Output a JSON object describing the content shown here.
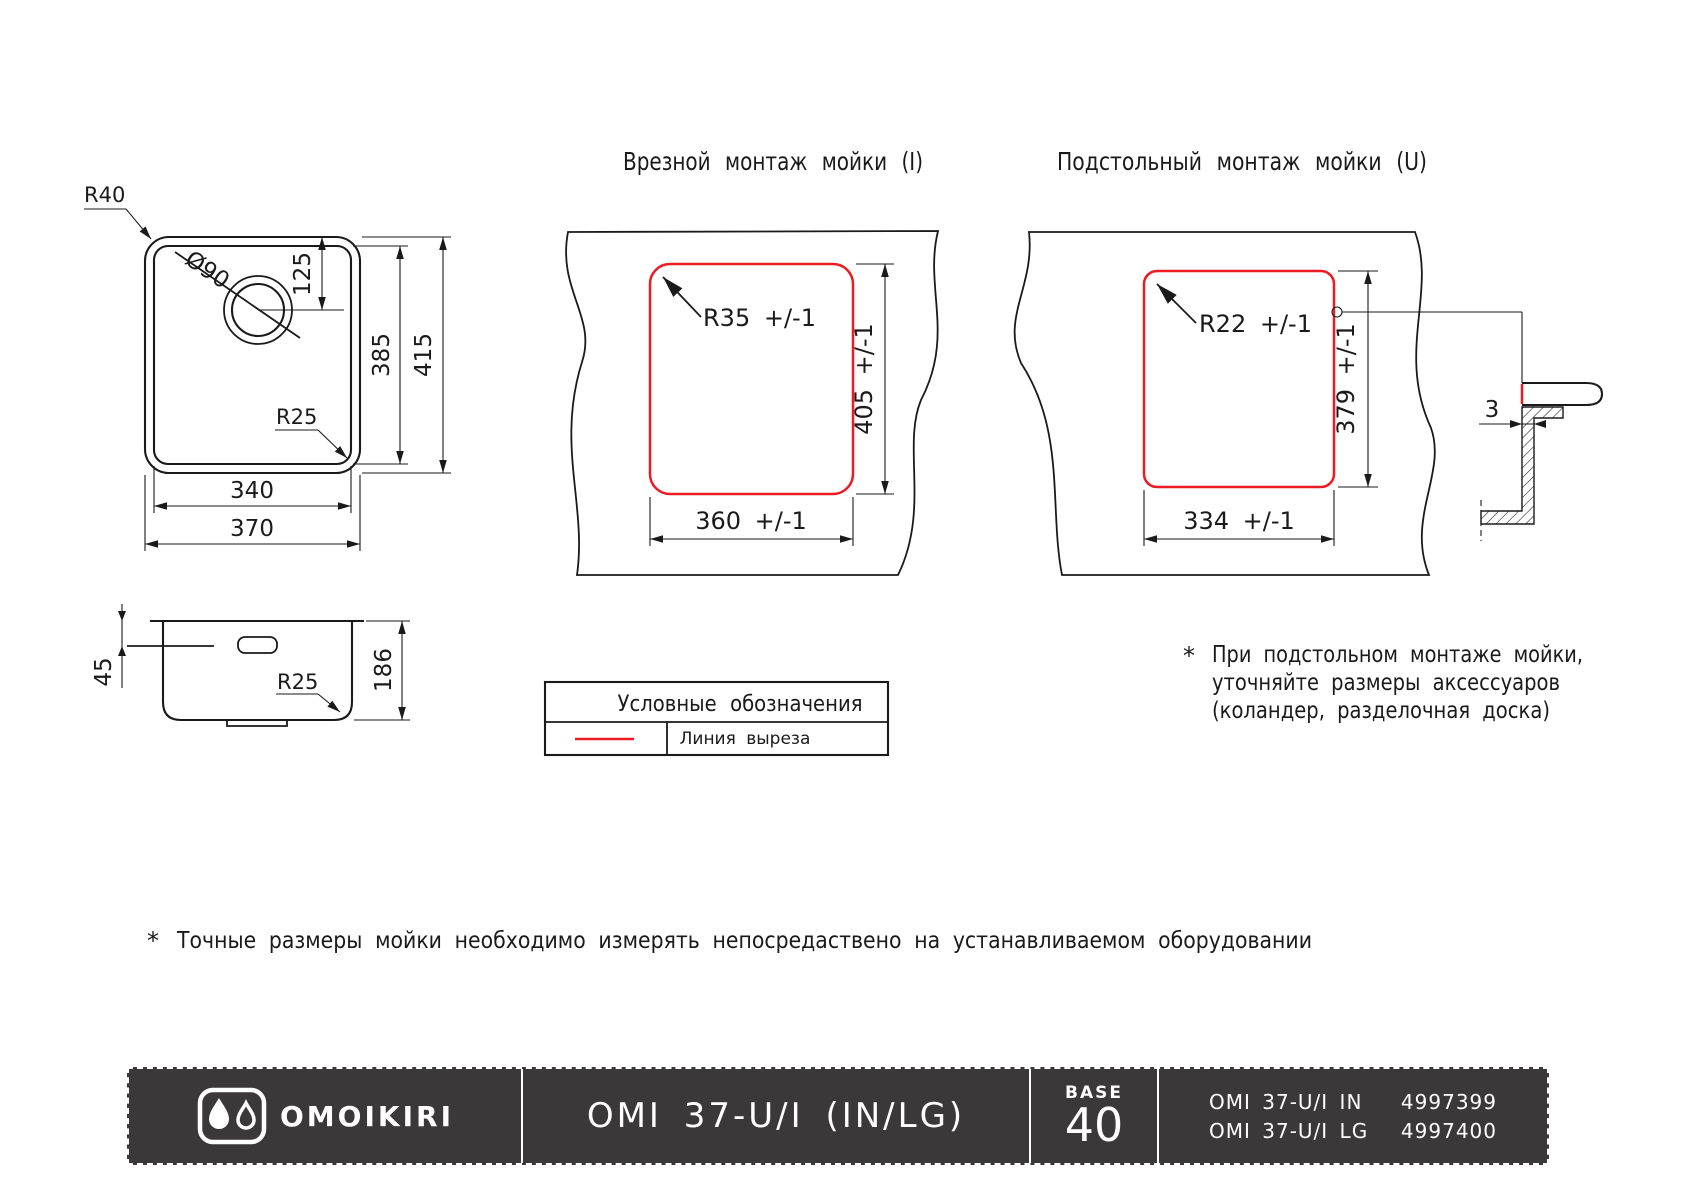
{
  "top_view": {
    "corner_radius": "R40",
    "drain_diameter": "Ø90",
    "drain_offset": "125",
    "inner_height": "385",
    "outer_height": "415",
    "inner_radius": "R25",
    "inner_width": "340",
    "outer_width": "370"
  },
  "side_view": {
    "rim_depth": "45",
    "height": "186",
    "bottom_radius": "R25"
  },
  "inset_mount": {
    "title": "Врезной монтаж мойки (I)",
    "corner_radius": "R35 +/-1",
    "cutout_height": "405 +/-1",
    "cutout_width": "360 +/-1"
  },
  "under_mount": {
    "title": "Подстольный монтаж мойки (U)",
    "corner_radius": "R22 +/-1",
    "cutout_height": "379 +/-1",
    "cutout_width": "334 +/-1",
    "edge_gap": "3"
  },
  "legend": {
    "title": "Условные обозначения",
    "cut_line": "Линия выреза"
  },
  "notes": {
    "under_star": "*",
    "under_line1": "При подстольном монтаже мойки,",
    "under_line2": "уточняйте размеры аксессуаров",
    "under_line3": "(коландер, разделочная доска)",
    "bottom_star": "*",
    "bottom_text": "Точные размеры мойки необходимо измерять непосредаствено на устанавливаемом оборудовании"
  },
  "footer": {
    "brand": "OMOIKIRI",
    "model": "OMI 37-U/I (IN/LG)",
    "base_label": "BASE",
    "base_value": "40",
    "products": [
      {
        "name": "OMI 37-U/I IN",
        "code": "4997399"
      },
      {
        "name": "OMI 37-U/I LG",
        "code": "4997400"
      }
    ]
  },
  "colors": {
    "cut_line": "#ed1c24",
    "footer_bg": "#3b3839",
    "ink": "#1a1a1a"
  }
}
